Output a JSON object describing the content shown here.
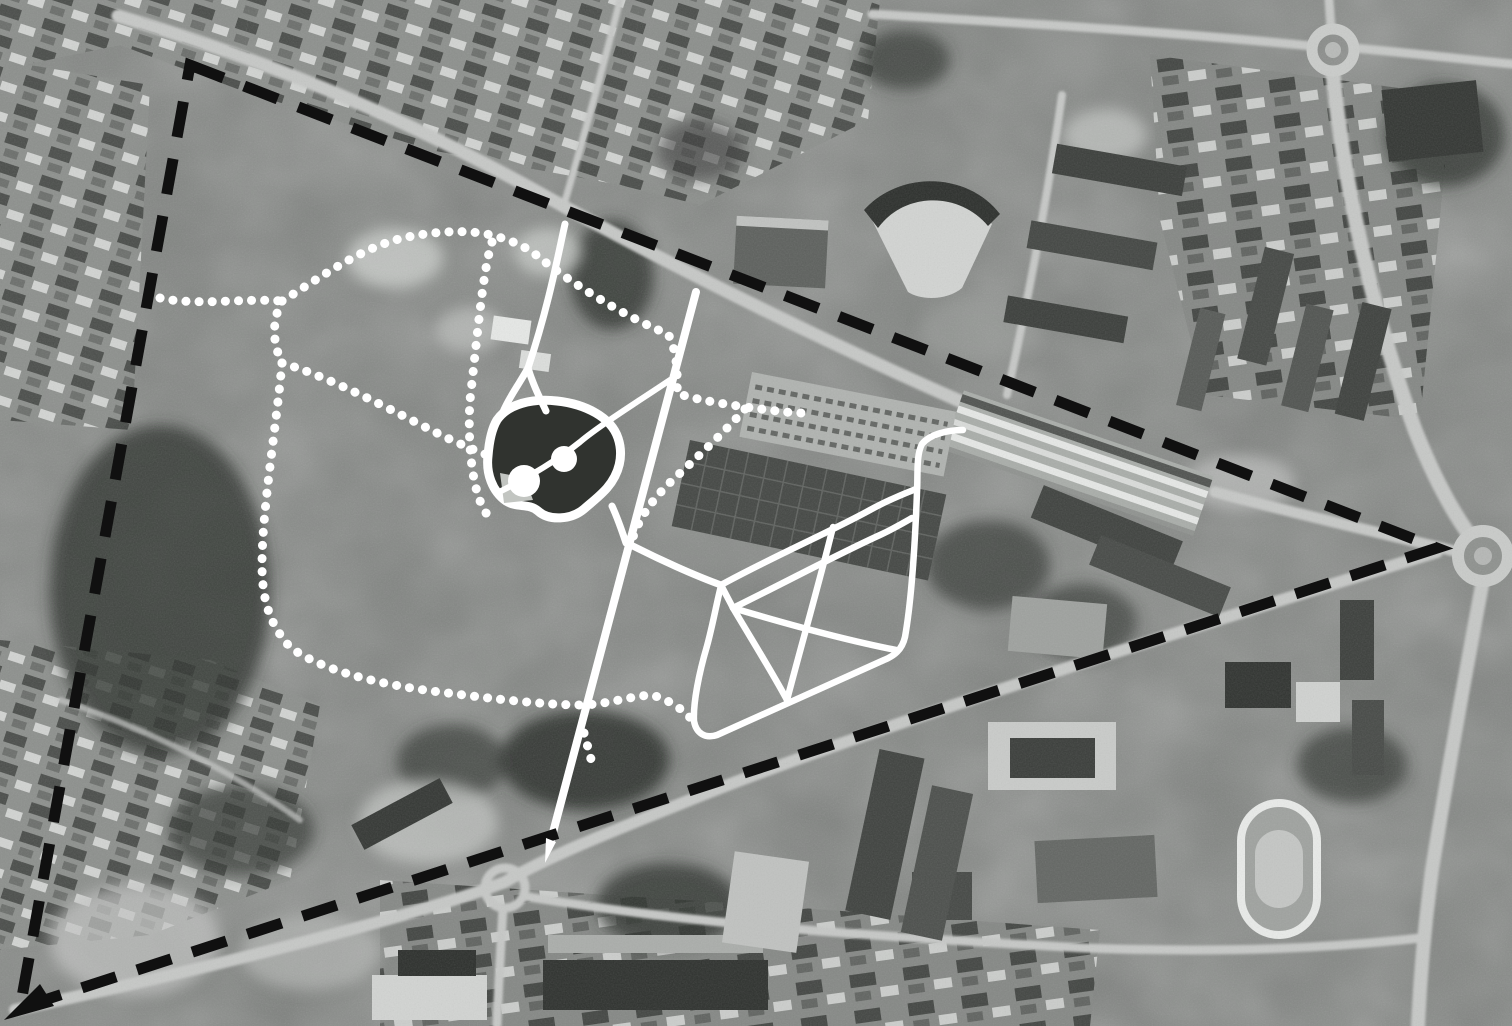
{
  "figure": {
    "kind": "annotated-aerial-photograph",
    "width": 1512,
    "height": 1026,
    "visible_text": "none"
  },
  "colors": {
    "photo_base": "#828582",
    "boundary_black": "#101010",
    "overlay_white": "#ffffff",
    "pond_fill": "#30332f",
    "pond_beach": "#c2c5c1"
  },
  "annotation_overlay": {
    "stroke_color": "#ffffff",
    "dot_style": {
      "stroke_width": 9,
      "dash": "0.1 13"
    },
    "boundary": {
      "name": "site-boundary-dashed",
      "color": "#101010",
      "stroke_width": 11,
      "dash": "36 22",
      "d": "M 190 65 L 1437 548 L 20 1008 Z"
    },
    "arrows": [
      {
        "name": "boundary-arrow-tip",
        "color": "#101010",
        "points": "4,1020 40,984 54,1006"
      },
      {
        "name": "central-path-arrow-tip",
        "color": "#ffffff",
        "points": "556,842 546,838 545,863"
      }
    ],
    "solid_paths": [
      {
        "name": "north-path-a",
        "w": 7,
        "d": "M 565 224 C 558 255 549 305 528 368"
      },
      {
        "name": "north-path-a-fork-left",
        "w": 7,
        "d": "M 528 368 C 518 386 508 399 503 412"
      },
      {
        "name": "north-path-a-fork-right",
        "w": 7,
        "d": "M 528 368 C 534 388 541 400 546 411"
      },
      {
        "name": "central-path",
        "w": 8,
        "d": "M 696 292 L 551 840"
      },
      {
        "name": "pond-link-path",
        "w": 7,
        "d": "M 612 506 C 618 519 622 531 626 543"
      },
      {
        "name": "pond-diagonal-path",
        "w": 6,
        "d": "M 497 493 C 530 477 560 458 580 442 C 600 425 645 397 670 380"
      },
      {
        "name": "loop-arm-path",
        "w": 7,
        "d": "M 627 543 C 660 560 696 576 721 585"
      },
      {
        "name": "loop-outer-path",
        "w": 6.5,
        "d": "M 963 430 C 948 430 930 434 922 444 C 916 455 918 475 917 492 C 915 545 911 603 905 637 C 902 650 894 656 884 660 L 717 735 C 705 739 696 733 694 721 C 693 703 699 673 707 646 C 713 624 717 601 721 586"
      },
      {
        "name": "loop-top-diagonal",
        "w": 6.5,
        "d": "M 721 585 C 770 558 830 532 870 510 C 890 499 906 493 916 489"
      },
      {
        "name": "loop-second-diagonal",
        "w": 6.5,
        "d": "M 733 608 C 780 585 840 553 880 535 C 895 528 905 522 912 518"
      },
      {
        "name": "loop-junction-link",
        "w": 6.5,
        "d": "M 721 585 C 725 593 729 600 733 608"
      },
      {
        "name": "loop-chord-east",
        "w": 6.5,
        "d": "M 733 608 C 780 622 845 640 896 650"
      },
      {
        "name": "loop-chord-steep",
        "w": 6.5,
        "d": "M 833 527 C 820 580 800 650 787 700"
      },
      {
        "name": "loop-chord-south",
        "w": 6.5,
        "d": "M 733 608 C 752 640 772 672 787 700"
      }
    ],
    "pond": {
      "name": "pond",
      "ring_width": 9,
      "fill": "#30332f",
      "outline_d": "M 497 420 C 508 404 532 398 557 401 C 585 404 611 417 618 438 C 624 456 619 474 607 488 C 600 496 592 502 584 509 C 571 520 549 521 538 511 C 529 503 517 508 506 501 C 492 491 486 473 488 456 C 489 443 491 430 497 420 Z",
      "beach_points": "500,473 525,478 533,500 504,503",
      "beach_color": "#c2c5c1",
      "circles": [
        {
          "name": "pond-island-large",
          "cx": 524,
          "cy": 481,
          "r": 16
        },
        {
          "name": "pond-island-small",
          "cx": 564,
          "cy": 459,
          "r": 13
        }
      ]
    },
    "dotted_paths": [
      {
        "name": "dotted-path-west-link",
        "d": "M 160 298 C 195 306 245 298 282 301"
      },
      {
        "name": "dotted-path-north-loop",
        "d": "M 282 301 C 320 278 360 248 403 238 C 435 231 470 229 495 236 C 520 243 530 250 540 258 C 570 282 625 317 668 334 C 676 348 678 370 677 393 C 690 399 740 407 770 410 C 782 412 795 413 803 413"
      },
      {
        "name": "dotted-path-parking-to-junction",
        "d": "M 745 409 C 728 428 700 455 678 475 C 655 496 640 515 632 540"
      },
      {
        "name": "dotted-path-junction-drop",
        "d": "M 282 301 C 272 320 272 342 282 363"
      },
      {
        "name": "dotted-path-to-pond",
        "d": "M 282 363 C 330 377 395 412 437 433 C 455 442 472 449 487 455"
      },
      {
        "name": "dotted-path-south-loop",
        "d": "M 282 363 C 276 430 262 510 262 565 C 262 600 270 625 290 647 C 320 670 380 685 440 692 C 495 699 545 705 583 705 C 612 704 640 693 655 696 C 672 701 690 714 697 727"
      },
      {
        "name": "dotted-path-vertical",
        "d": "M 492 242 C 483 270 478 330 470 400 C 468 430 470 470 478 495 C 482 508 487 515 492 521"
      },
      {
        "name": "dotted-path-spur",
        "d": "M 584 733 C 588 748 591 758 593 768"
      }
    ]
  }
}
